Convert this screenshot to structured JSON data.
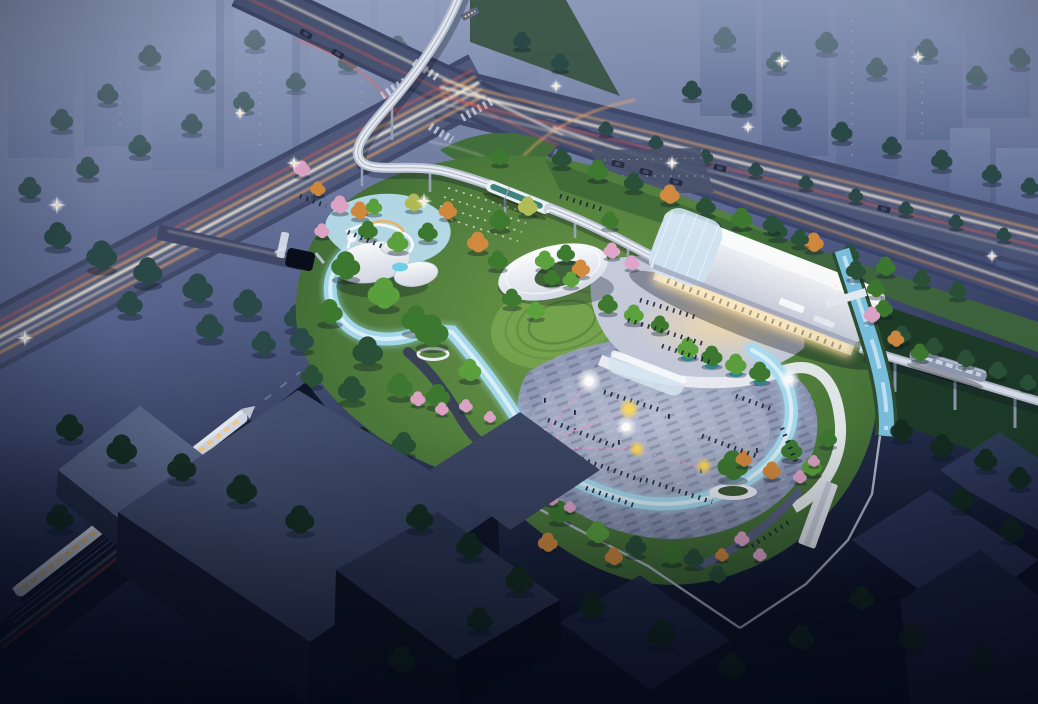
{
  "scene": {
    "type": "aerial-architectural-rendering",
    "time_of_day": "dusk",
    "description": "Bird's-eye dusk rendering of a transit-oriented urban park: an arched monorail station hall with glowing base, elevated guideway with two trams, an event plaza with crowds, glowing balloons and pink light ropes, a luminous blue loop promenade, ring-shaped white canopy pavilion, playground with white slide pavilions, highway interchange with car light trails, hazy high-rise skyline, a passenger train and dark industrial blocks in the foreground",
    "elements": [
      "city-highrise-backdrop",
      "arterial-roads-with-light-trails",
      "highway-intersection",
      "elevated-monorail-guideway",
      "monorail-trams",
      "transit-station-hall",
      "station-forecourt",
      "urban-park",
      "playground",
      "pavilion-cluster",
      "ring-canopy-pavilion",
      "amphitheater-lawn",
      "event-plaza-with-crowd",
      "glowing-balloons",
      "illuminated-loop-promenade",
      "water-channel",
      "tree-groves",
      "cherry-blossom-trees",
      "boundary-wall",
      "park-gate",
      "industrial-buildings",
      "passenger-train",
      "street-lamps",
      "parking-lot",
      "tunnel-portal"
    ]
  },
  "palette": {
    "sky_top": "#8d9ab9",
    "sky_mid": "#4e5a82",
    "sky_deep": "#0c1426",
    "haze": "#a2aecb",
    "road": "#525c7e",
    "road_dark": "#414a6a",
    "trail_white": "#fff3de",
    "trail_warm": "#ffb36b",
    "trail_red": "#ff6350",
    "lamp": "#ffeab4",
    "park_green": "#4c7a3b",
    "lawn_light": "#76a44e",
    "tree_green": "#3e7a30",
    "tree_green_light": "#5ca23d",
    "tree_deep": "#2a5238",
    "tree_teal": "#2c4b49",
    "tree_dark": "#132c1e",
    "tree_orange": "#d28a3e",
    "tree_pink": "#e0a5c8",
    "tree_yellow": "#b3bd55",
    "path_white": "#edf2f8",
    "ribbon": "#a9def2",
    "water": "#7fc8ea",
    "plaza": "#98a2bf",
    "canopy_white": "#f3f5f9",
    "glow_warm": "#ffdf9e",
    "block_top": "#465072",
    "block_mid": "#2b3450",
    "block_side": "#131a2f",
    "crowd": "#1b2338",
    "balloon_yellow": "#ffd95e",
    "pink_line": "#ff9cd0",
    "train_body": "#d8dee9",
    "train_window": "#ffcf7a",
    "tram_teal": "#2f7a74",
    "wall": "#b9bfce"
  }
}
